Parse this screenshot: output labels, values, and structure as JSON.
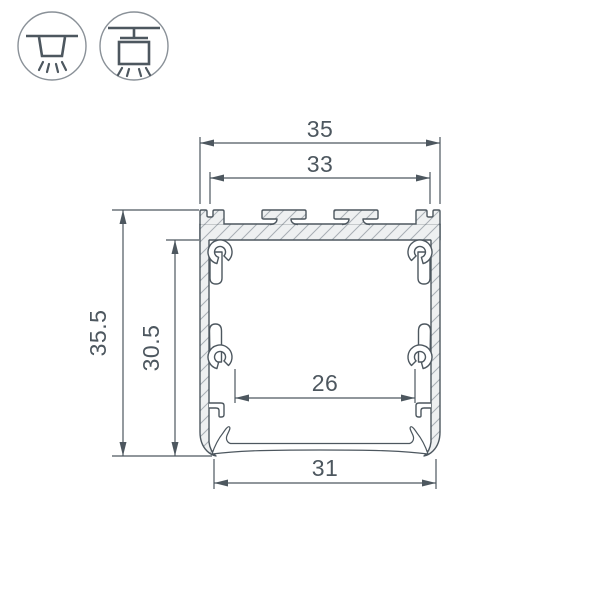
{
  "colors": {
    "background": "#ffffff",
    "ink": "#4d575f",
    "icon_outline": "#8a9198",
    "metal_fill": "#eef0f1",
    "hatch_line": "#a8aeb4"
  },
  "mount_icons": [
    {
      "name": "surface-mounted-luminaire-icon"
    },
    {
      "name": "suspended-luminaire-icon"
    }
  ],
  "dimensions": {
    "outer_width": "35",
    "slot_width": "33",
    "outer_height": "35.5",
    "inner_height": "30.5",
    "inner_width": "26",
    "bottom_width": "31"
  }
}
